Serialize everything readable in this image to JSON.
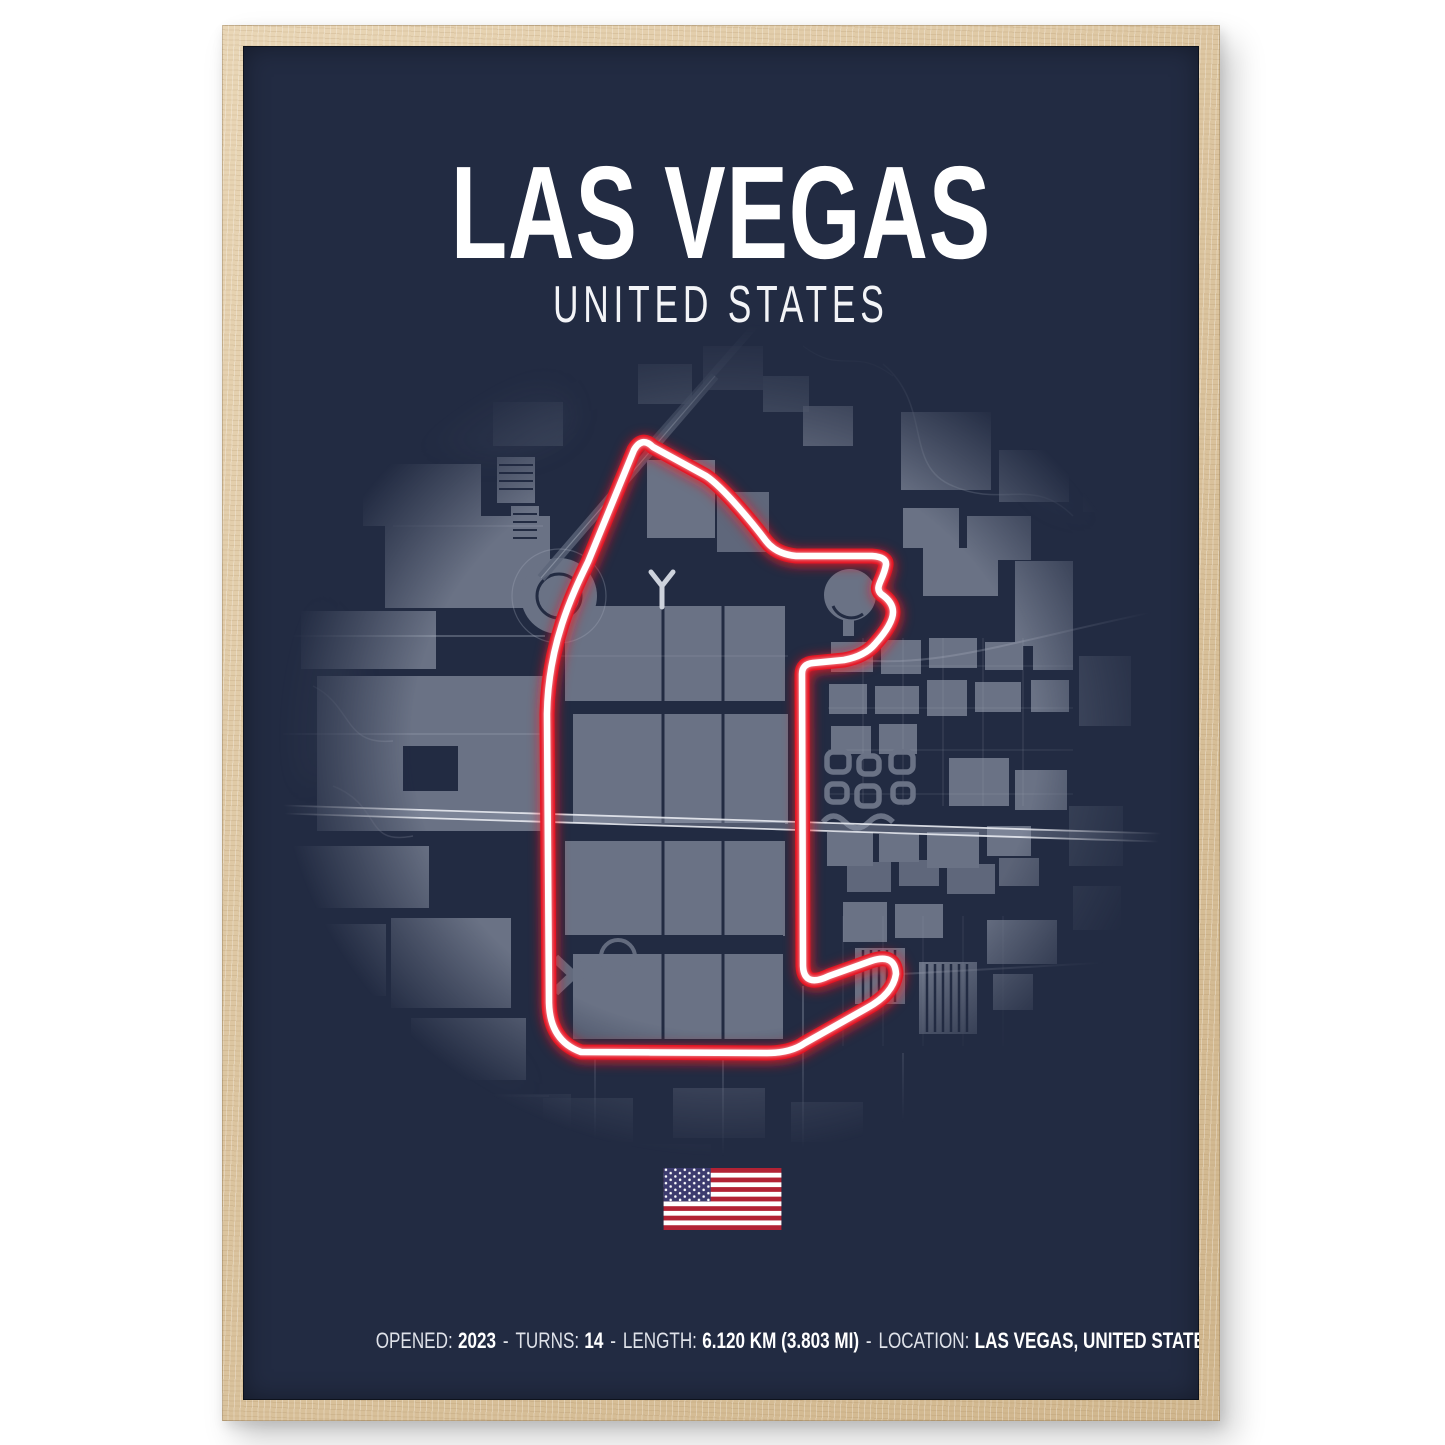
{
  "poster": {
    "title": "LAS VEGAS",
    "subtitle": "UNITED STATES",
    "flag": "united-states-flag",
    "stats": {
      "opened_label": "OPENED:",
      "opened_value": "2023",
      "turns_label": "TURNS:",
      "turns_value": "14",
      "length_label": "LENGTH:",
      "length_value": "6.120 KM (3.803 MI)",
      "location_label": "LOCATION:",
      "location_value": "LAS VEGAS, UNITED STATES",
      "separator": "-"
    },
    "colors": {
      "poster_background": "#222B42",
      "map_block_gray": "#6A7285",
      "street_line": "#AAB1BF",
      "track_red": "#E3111B",
      "track_line_white": "#FFFFFF",
      "frame_wood": "#DCC5A0",
      "flag_red": "#B22234",
      "flag_blue": "#3C3B6E",
      "text_white": "#FFFFFF"
    }
  }
}
